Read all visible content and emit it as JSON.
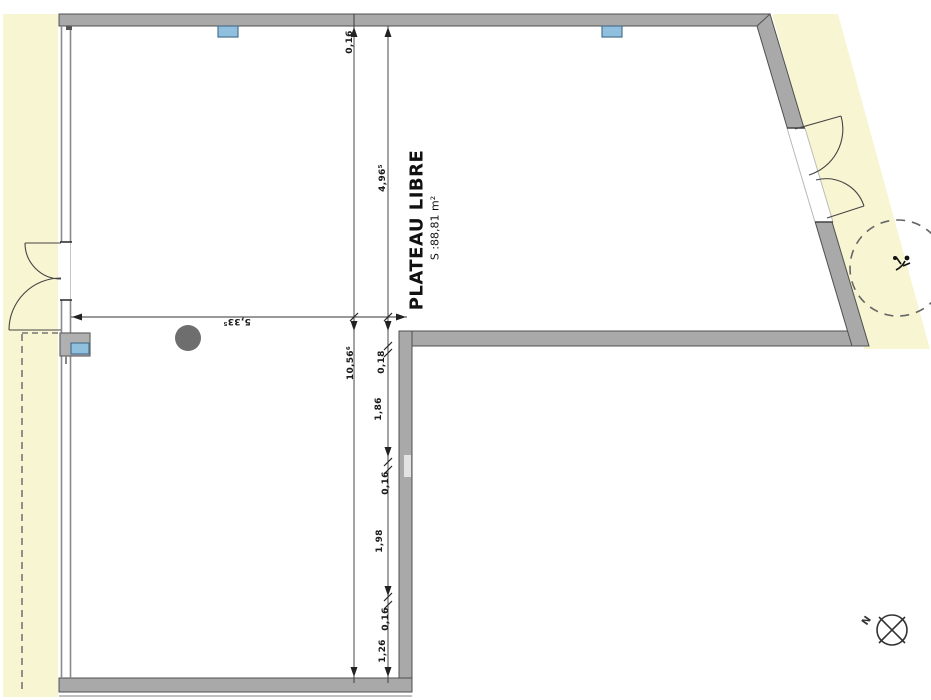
{
  "room": {
    "name": "PLATEAU LIBRE",
    "area": "S :88,81 m²"
  },
  "compass": {
    "north": "N"
  },
  "dims": {
    "wall_top": "0,16",
    "upper_height": "4,96⁵",
    "width": "5,33⁵",
    "total_height": "10,56⁶",
    "chain": [
      "0,18",
      "1,86",
      "0,16",
      "1,98",
      "0,16",
      "1,26"
    ]
  },
  "colors": {
    "zone_yellow": "#f8f6d2",
    "wall_gray": "#a9a9a9",
    "vent_blue": "#8fc0dd",
    "column_gray": "#6e6e6e"
  }
}
